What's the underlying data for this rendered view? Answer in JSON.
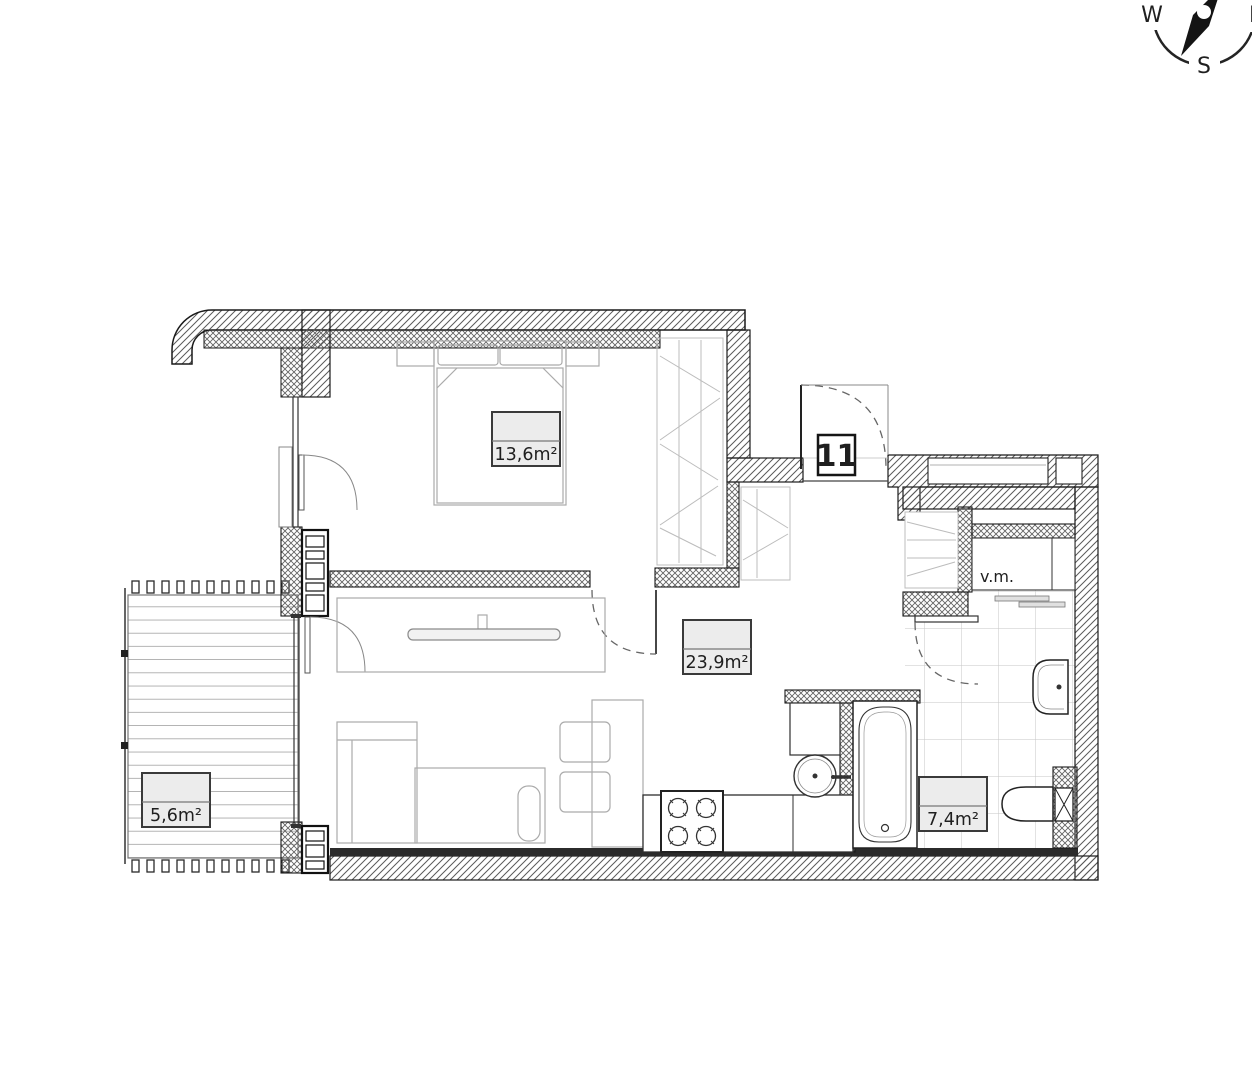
{
  "image": {
    "type": "apartment floor plan",
    "unit_number": "11"
  },
  "compass": {
    "west": "W",
    "south": "S",
    "east": "E"
  },
  "room_labels": {
    "bedroom": "13,6m²",
    "living_room": "23,9m²",
    "balcony": "5,6m²",
    "bathroom": "7,4m²"
  },
  "annotations": {
    "washing_machine": "v.m."
  },
  "colors": {
    "background": "#ffffff",
    "wall_outline": "#1a1a1a",
    "hatch_line": "#5a5a5a",
    "furniture_line": "#ababab",
    "tile_line": "#c6c6c6",
    "label_box_fill": "#ececec",
    "label_box_border": "#3a3a3a",
    "text": "#1f1f1f"
  }
}
